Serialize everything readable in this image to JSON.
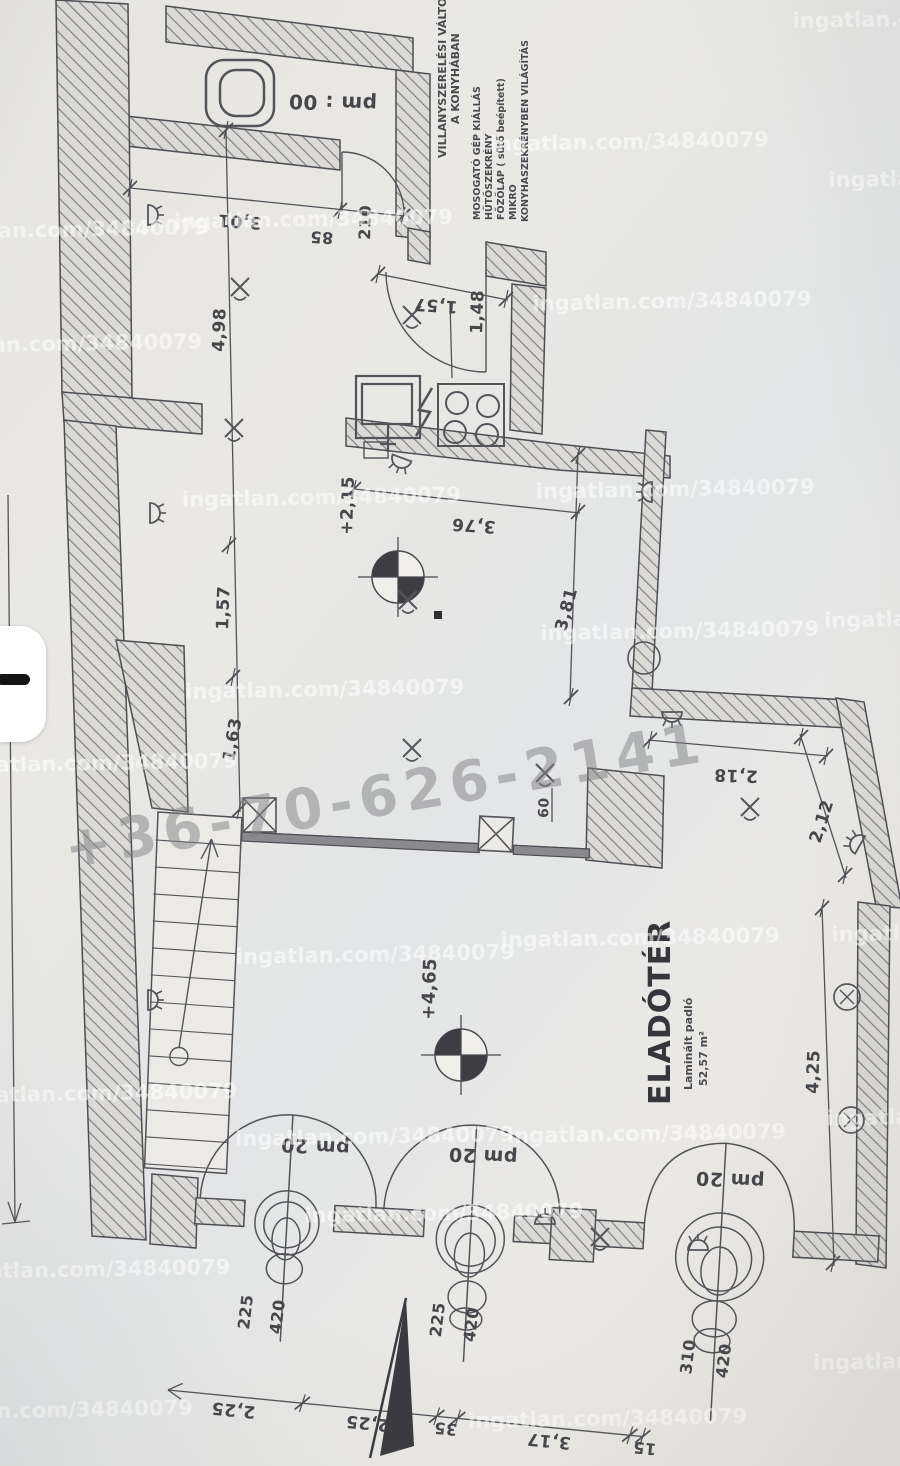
{
  "watermark": {
    "site": "ingatlan.com/34840079",
    "phone": "+36-70-626-2141"
  },
  "notes": {
    "title1": "VILLANYSZERELÉSI VÁLTOZÁSOK",
    "title2": "A KONYHÁBAN",
    "item1": "MOSOGATÓ GÉP KIÁLLÁS",
    "item2": "HŰTŐSZEKRÉNY",
    "item3": "FŐZŐLAP ( sütő beépített)",
    "item4": "MIKRO",
    "item5": "KONYHASZEKRÉNYBEN VILÁGÍTÁS"
  },
  "room": {
    "name": "ELADÓTÉR",
    "floor": "Laminált padló",
    "area": "52,57 m²"
  },
  "levels": {
    "mid": "+2,15",
    "main": "+4,65"
  },
  "labels": {
    "wc_parapet": "pm : 00",
    "door1_parapet": "pm 20",
    "door2_parapet": "pm 20",
    "door3_parapet": "pm 20"
  },
  "dims": {
    "wc_width": "3,01",
    "wc_door_width": "85",
    "wc_door_height": "210",
    "left_a": "4,98",
    "left_b": "1,57",
    "left_c": "1,63",
    "kitchen_width": "1,57",
    "kitchen_depth": "1,48",
    "hall_width": "3,76",
    "hall_depth": "3,81",
    "right_a": "2,18",
    "right_b": "2,12",
    "right_c": "4,25",
    "pillar_width": "60",
    "open1_width": "225",
    "open1_height": "420",
    "open2_width": "225",
    "open2_height": "420",
    "open3_width": "310",
    "open3_height": "420",
    "chain1": "2,25",
    "chain2": "2,25",
    "chain3": "35",
    "chain4": "3,17",
    "chain5": "15"
  }
}
